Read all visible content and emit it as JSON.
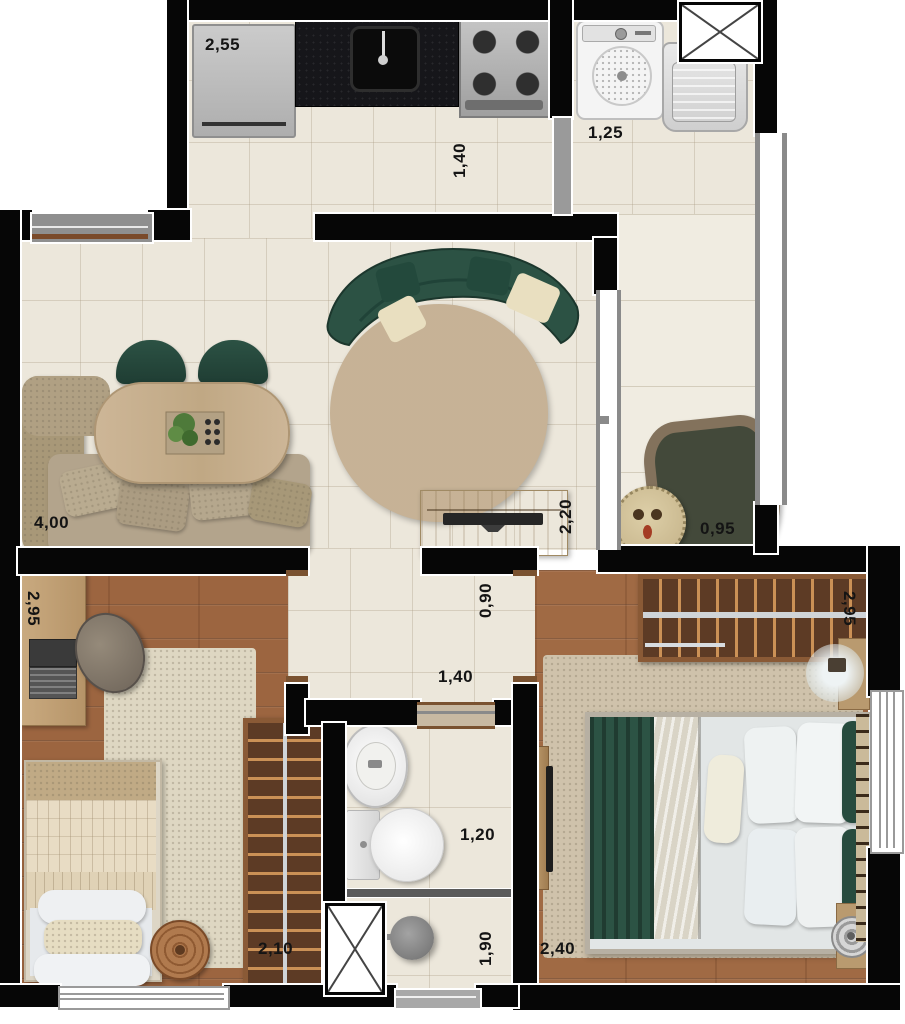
{
  "floorplan": {
    "type": "residential apartment floor plan - top view render",
    "labels": {
      "fridge_width": "2,55",
      "kitchen_depth": "1,40",
      "laundry_width": "1,25",
      "living_width": "4,00",
      "tv_stand_width": "2,20",
      "balcony_width": "0,95",
      "hall_width": "0,90",
      "hall_length": "1,40",
      "bedroom1_width": "2,95",
      "bedroom1_wardrobe": "2,10",
      "bathroom_width": "1,20",
      "shower_width": "1,90",
      "bedroom2_width": "2,95",
      "bedroom2_length": "2,40"
    },
    "colors": {
      "wall": "#060606",
      "tile_floor": "#ece7db",
      "wood_floor": "#9c6540",
      "sofa_green": "#2c5244",
      "rug_beige": "#d7c4a9",
      "wardrobe_wood": "#5d3b25",
      "window_gray": "#8f8f8f"
    },
    "rooms": [
      {
        "name": "kitchen",
        "furniture": [
          "refrigerator",
          "counter-with-sink",
          "stove-cooktop"
        ]
      },
      {
        "name": "laundry",
        "furniture": [
          "washing-machine",
          "laundry-tank",
          "duct-shaft"
        ]
      },
      {
        "name": "living-dining",
        "furniture": [
          "corner-sofa",
          "oval-dining-table",
          "dining-chairs",
          "curved-green-sofa",
          "round-rug",
          "tv-stand"
        ]
      },
      {
        "name": "balcony",
        "furniture": [
          "dark-rug",
          "pouf"
        ]
      },
      {
        "name": "hallway",
        "furniture": []
      },
      {
        "name": "bedroom-1",
        "furniture": [
          "desk-with-laptop",
          "office-chair",
          "single-bed",
          "round-stool",
          "wardrobe",
          "rug"
        ]
      },
      {
        "name": "bathroom",
        "furniture": [
          "washbasin",
          "toilet",
          "shower",
          "glass-partition",
          "duct-shaft"
        ]
      },
      {
        "name": "bedroom-2",
        "furniture": [
          "wardrobe",
          "double-bed",
          "rug",
          "wall-tv-shelf",
          "nightstand-lamp"
        ]
      }
    ]
  }
}
